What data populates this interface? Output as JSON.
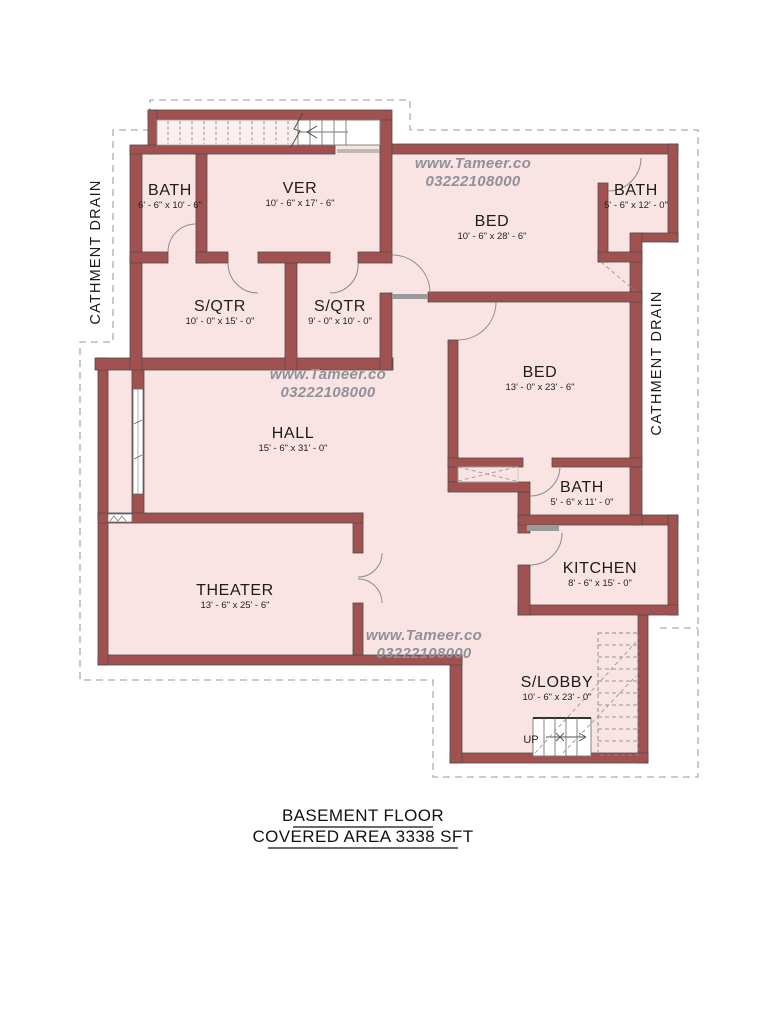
{
  "page": {
    "background": "#ffffff"
  },
  "title": {
    "line1": "BASEMENT FLOOR",
    "line2": "COVERED AREA  3338 SFT"
  },
  "watermark": {
    "site": "www.Tameer.co",
    "phone": "03222108000"
  },
  "labels": {
    "catchment_left": "CATHMENT DRAIN",
    "catchment_right": "CATHMENT DRAIN",
    "up": "UP"
  },
  "rooms": {
    "bath1": {
      "name": "BATH",
      "dims": "6' - 6\" x 10' - 6\""
    },
    "ver": {
      "name": "VER",
      "dims": "10' - 6\" x 17' - 6\""
    },
    "bed1": {
      "name": "BED",
      "dims": "10' - 6\" x 28' - 6\""
    },
    "bath2": {
      "name": "BATH",
      "dims": "5' - 6\" x 12' - 0\""
    },
    "sqtr1": {
      "name": "S/QTR",
      "dims": "10' - 0\" x 15' - 0\""
    },
    "sqtr2": {
      "name": "S/QTR",
      "dims": "9' - 0\" x 10' - 0\""
    },
    "bed2": {
      "name": "BED",
      "dims": "13' - 0\" x 23' - 6\""
    },
    "hall": {
      "name": "HALL",
      "dims": "15' - 6\" x 31' - 0\""
    },
    "bath3": {
      "name": "BATH",
      "dims": "5' - 6\" x 11' - 0\""
    },
    "kitchen": {
      "name": "KITCHEN",
      "dims": "8' - 6\" x 15' - 0\""
    },
    "theater": {
      "name": "THEATER",
      "dims": "13' - 6\" x 25' - 6\""
    },
    "slobby": {
      "name": "S/LOBBY",
      "dims": "10' - 6\" x 23' - 0\""
    }
  },
  "colors": {
    "wall": "#A15250",
    "wall_outline": "#4D4D4D",
    "floor": "#F9E4E3",
    "watermark": "#90909A",
    "text": "#1C1C1C"
  }
}
